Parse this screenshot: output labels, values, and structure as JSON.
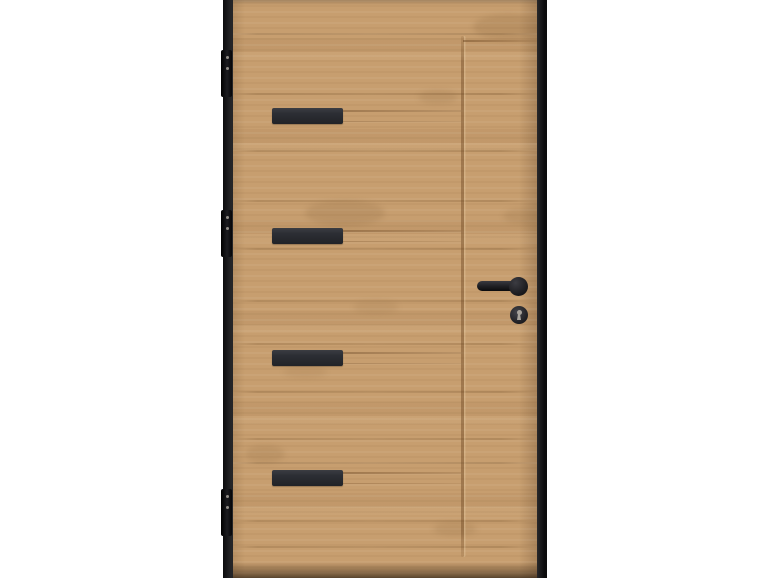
{
  "scene": {
    "type": "product-photo",
    "subject": "modern-wooden-entry-door-with-black-inlays",
    "text_content": "none"
  },
  "colors": {
    "background": "#ffffff",
    "frame": "#17171a",
    "wood_base": "#c79e6f",
    "wood_dark": "#a87f50",
    "seam": "#7d5a33",
    "strip": "#2c2e34",
    "groove": "#8a6237",
    "hardware": "#1e1e22",
    "hardware_light": "#a9a49c"
  },
  "door": {
    "inlay_strip_count": 4,
    "inlay_strips": [
      {
        "y": 108
      },
      {
        "y": 228
      },
      {
        "y": 350
      },
      {
        "y": 470
      }
    ],
    "hinge_count": 3,
    "hinges": [
      {
        "y": 50
      },
      {
        "y": 210
      },
      {
        "y": 489
      }
    ],
    "plank_seams": [
      33,
      93,
      150,
      200,
      248,
      300,
      343,
      391,
      438,
      462,
      520,
      546
    ],
    "grain_marks": [
      {
        "x": 72,
        "y": 200,
        "w": 80,
        "h": 26,
        "o": 0.16
      },
      {
        "x": 240,
        "y": 14,
        "w": 70,
        "h": 26,
        "o": 0.18
      },
      {
        "x": 185,
        "y": 90,
        "w": 40,
        "h": 14,
        "o": 0.14
      },
      {
        "x": 12,
        "y": 445,
        "w": 40,
        "h": 18,
        "o": 0.15
      },
      {
        "x": 120,
        "y": 300,
        "w": 46,
        "h": 14,
        "o": 0.1
      },
      {
        "x": 270,
        "y": 208,
        "w": 40,
        "h": 16,
        "o": 0.14
      },
      {
        "x": 200,
        "y": 522,
        "w": 44,
        "h": 14,
        "o": 0.14
      },
      {
        "x": 50,
        "y": 366,
        "w": 44,
        "h": 12,
        "o": 0.1
      }
    ]
  }
}
